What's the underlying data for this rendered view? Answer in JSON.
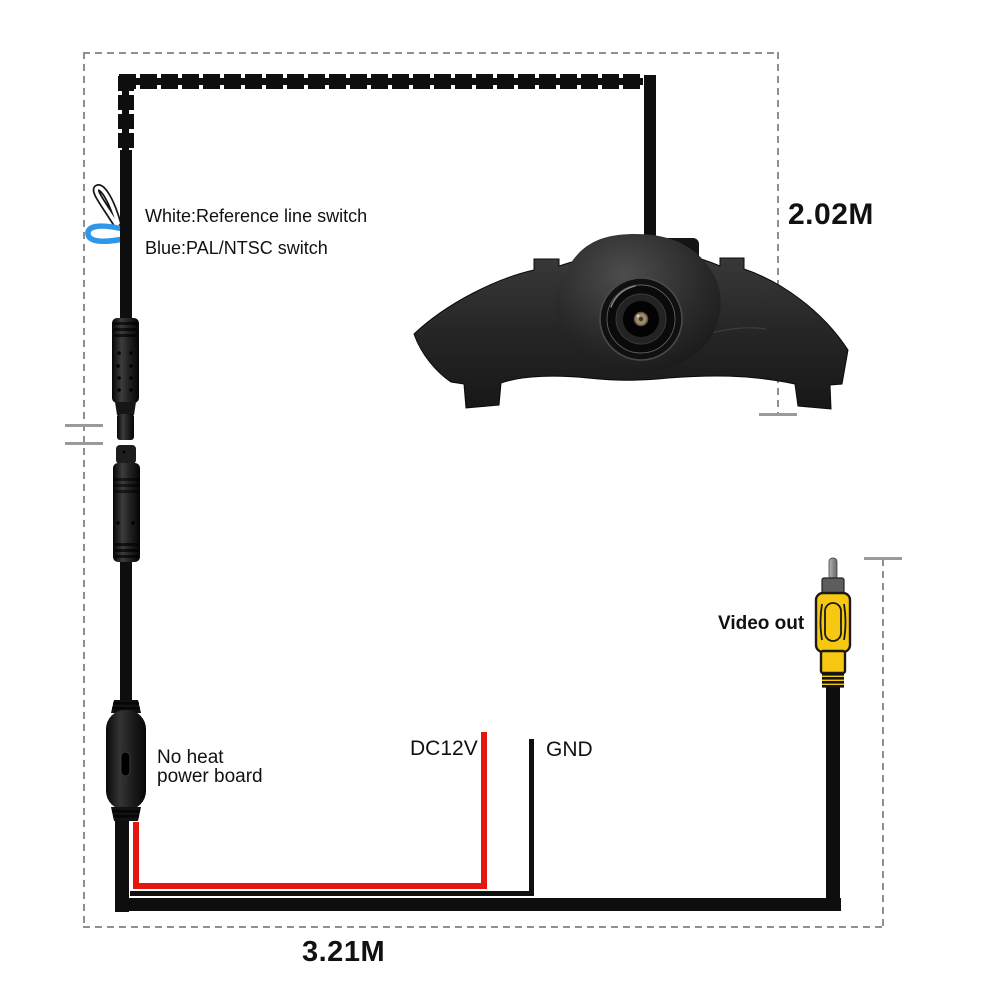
{
  "diagram": {
    "switch_labels": {
      "white": "White:Reference line switch",
      "blue": "Blue:PAL/NTSC switch"
    },
    "measurements": {
      "camera_cable_length": "2.02M",
      "power_cable_length": "3.21M"
    },
    "power_board_label": {
      "line1": "No heat",
      "line2": "power board"
    },
    "wire_labels": {
      "power": "DC12V",
      "ground": "GND",
      "video": "Video out"
    },
    "colors": {
      "power_wire_red": "#e41710",
      "pal_ntsc_switch_blue": "#2f97e8",
      "rca_plug_yellow": "#f6c811",
      "cable_black": "#0e0e0e",
      "dash_gray": "#8f8f8f"
    }
  }
}
